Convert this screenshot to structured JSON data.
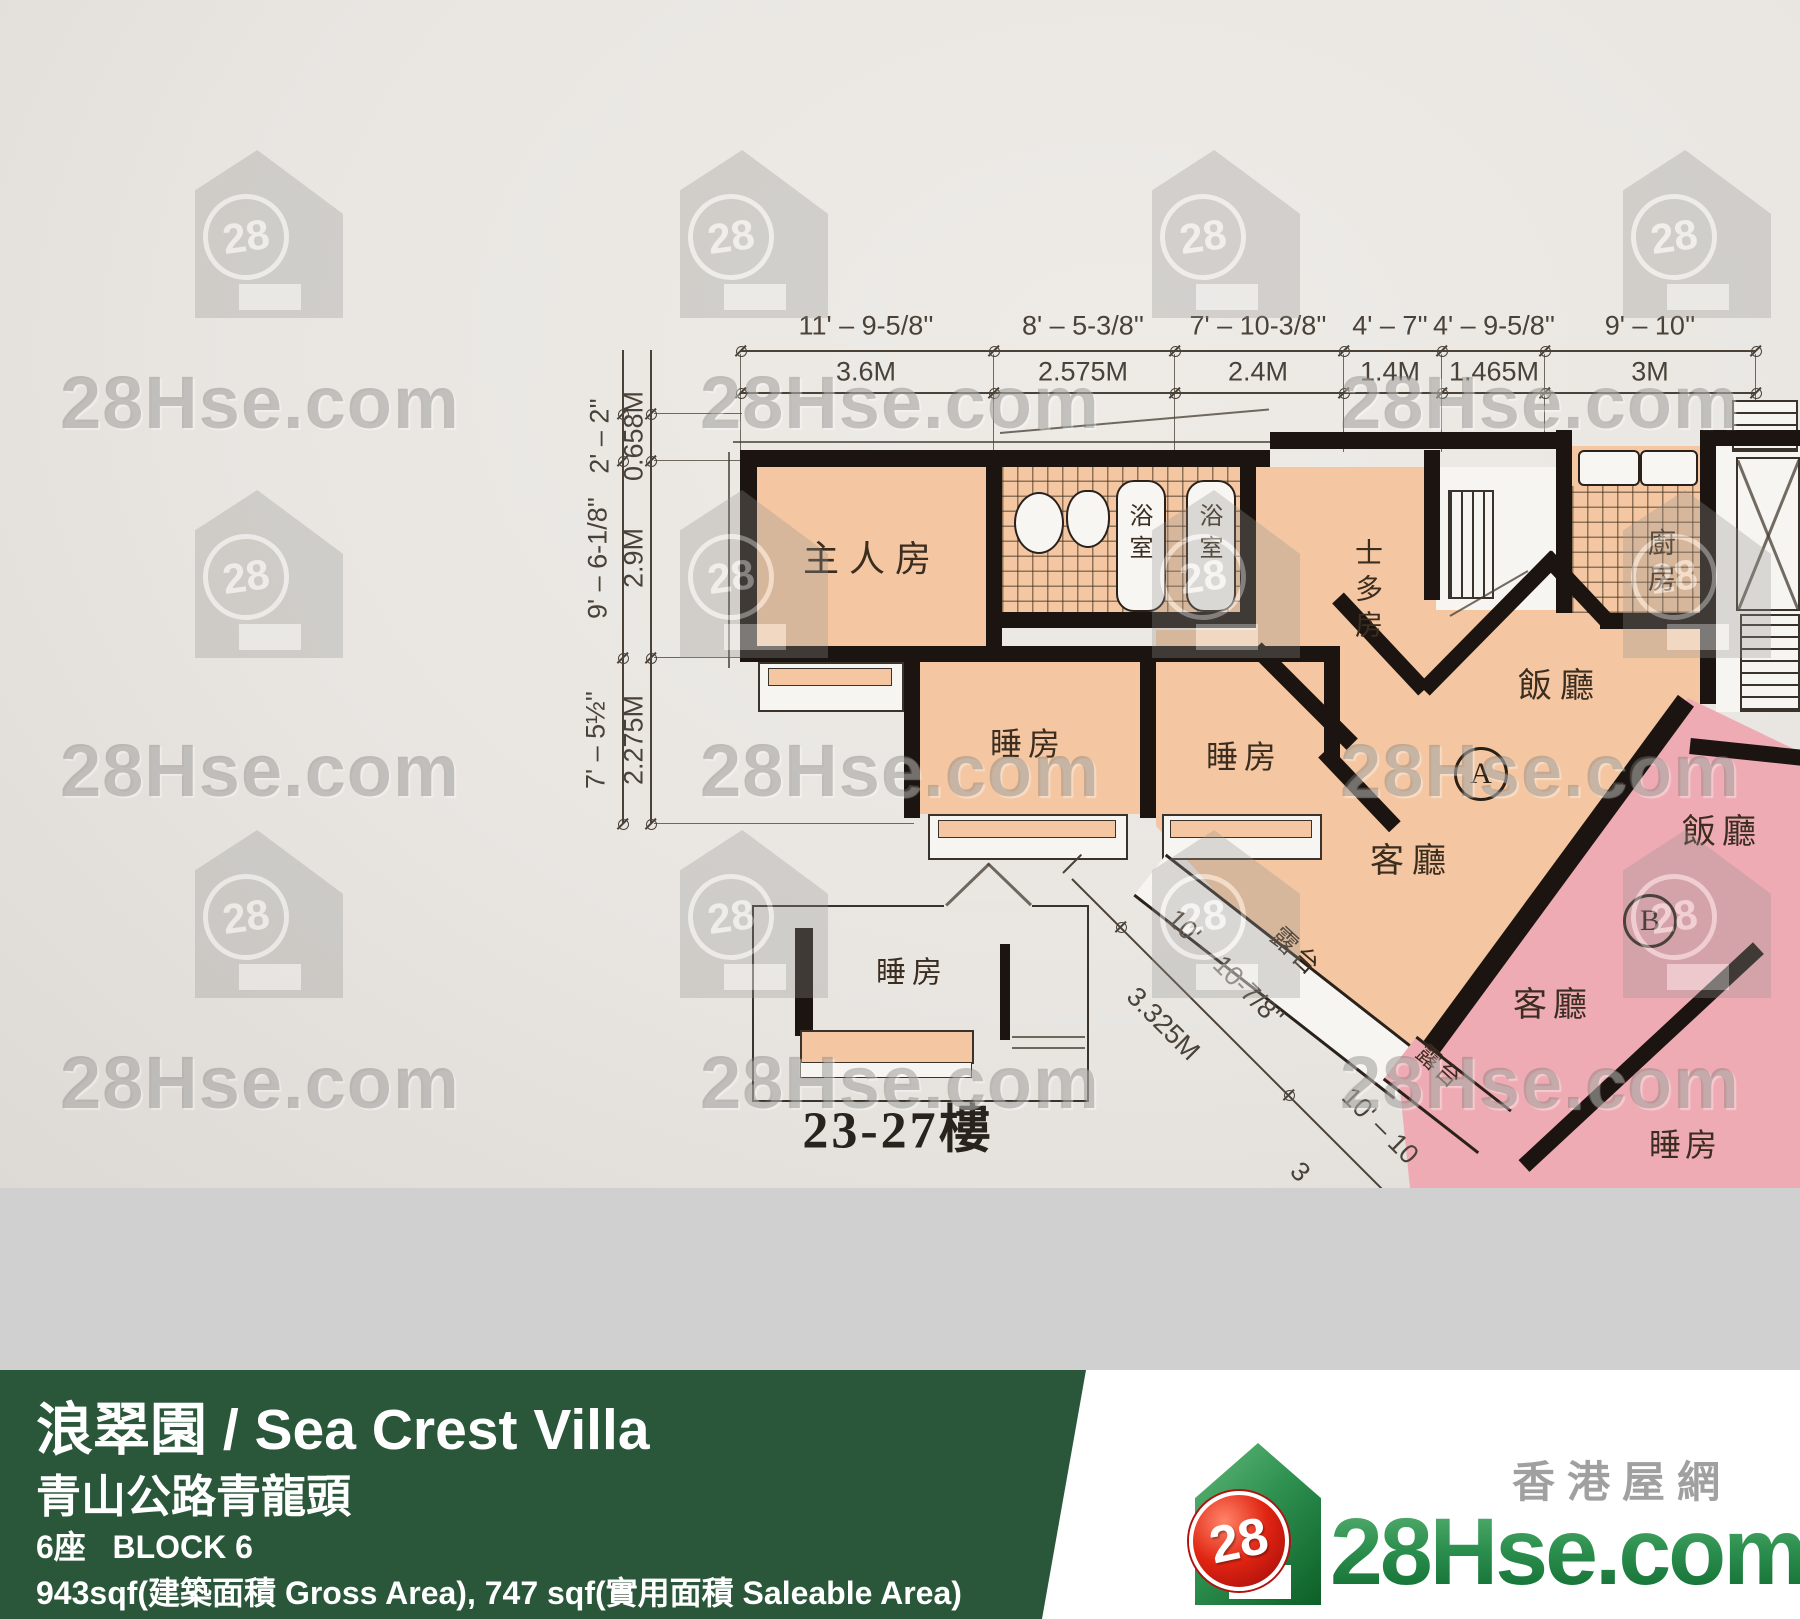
{
  "watermark": {
    "brand": "28Hse.com",
    "number": "28"
  },
  "plan": {
    "top_dims": [
      {
        "imperial": "11' – 9-5/8''",
        "metric": "3.6M"
      },
      {
        "imperial": "8' – 5-3/8''",
        "metric": "2.575M"
      },
      {
        "imperial": "7' – 10-3/8''",
        "metric": "2.4M"
      },
      {
        "imperial": "4' – 7''",
        "metric": "1.4M"
      },
      {
        "imperial": "4' – 9-5/8''",
        "metric": "1.465M"
      },
      {
        "imperial": "9' – 10''",
        "metric": "3M"
      }
    ],
    "left_dims": [
      {
        "imperial": "2' – 2''",
        "metric": "0.658M"
      },
      {
        "imperial": "9' – 6-1/8''",
        "metric": "2.9M"
      },
      {
        "imperial": "7' – 5½''",
        "metric": "2.275M"
      }
    ],
    "diag_dims": [
      {
        "imperial": "10' – 10-7/8''",
        "metric": "3.325M"
      },
      {
        "imperial": "10' – 10",
        "metric": "3"
      }
    ],
    "labels": {
      "master_bedroom": "主人房",
      "bathroom": "浴室",
      "store_room": "士多房",
      "kitchen": "廚房",
      "dining": "飯廳",
      "living": "客廳",
      "bedroom": "睡房",
      "balcony": "露台",
      "unit_a": "A",
      "unit_b": "B",
      "inset_floors": "23-27樓"
    }
  },
  "banner": {
    "title": "浪翠園 / Sea Crest Villa",
    "address": "青山公路青龍頭",
    "block": "6座   BLOCK 6",
    "area": "943sqf(建築面積 Gross Area), 747 sqf(實用面積 Saleable Area)"
  },
  "logo": {
    "site": "28Hse.com",
    "chinese": "香港屋網",
    "number": "28"
  },
  "colors": {
    "banner_green": "#2a5639",
    "paper": "#e9e6e2",
    "gray_strip": "#d0d0d0",
    "peach": "#f4c7a2",
    "pink": "#efabb4",
    "wall": "#1b1410",
    "logo_green": "#1e7c35",
    "logo_red": "#cf1818"
  }
}
